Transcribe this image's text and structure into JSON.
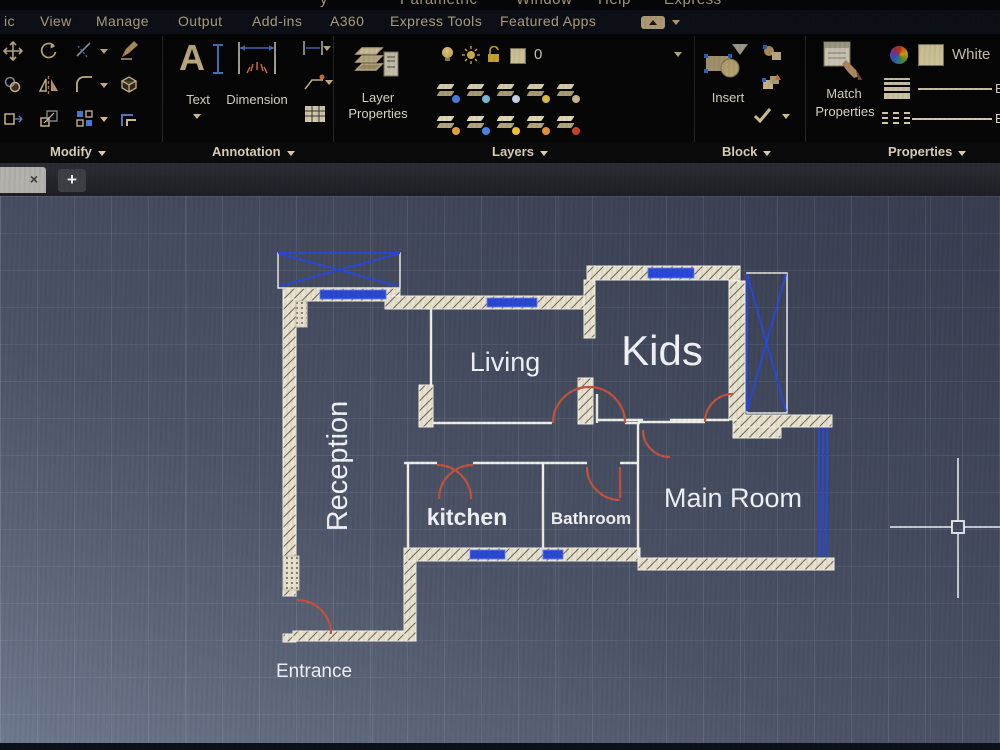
{
  "menubar": {
    "fragments": [
      "y",
      "Parametric",
      "Window",
      "Help",
      "Express"
    ]
  },
  "tabs": [
    "ic",
    "View",
    "Manage",
    "Output",
    "Add-ins",
    "A360",
    "Express Tools",
    "Featured Apps"
  ],
  "panel_labels": {
    "modify": "Modify",
    "annotation": "Annotation",
    "layers": "Layers",
    "block": "Block",
    "properties": "Properties"
  },
  "tools": {
    "text": "Text",
    "text_icon_letter": "A",
    "dimension": "Dimension",
    "layer_props_1": "Layer",
    "layer_props_2": "Properties",
    "current_layer": "0",
    "insert": "Insert",
    "match_1": "Match",
    "match_2": "Properties",
    "color_name": "White",
    "bylayer": "B"
  },
  "file_tabs": {
    "close": "×",
    "new": "+"
  },
  "plan": {
    "reception": "Reception",
    "living": "Living",
    "kids": "Kids",
    "kitchen": "kitchen",
    "bathroom": "Bathroom",
    "main_room": "Main Room",
    "entrance": "Entrance"
  },
  "colors": {
    "accent_tan": "#d9c291",
    "window_blue": "#2a48d6",
    "door_red": "#c4523c",
    "wall_cream": "#e7e2cf",
    "canvas_slate": "#4d5468"
  }
}
